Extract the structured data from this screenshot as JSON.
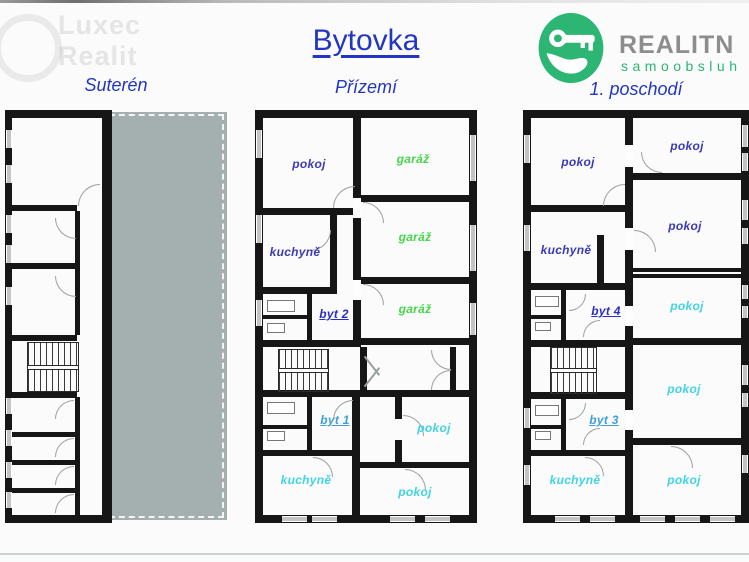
{
  "page": {
    "background": "#fbfbfb",
    "top_strip_color": "#8a8a8a",
    "bottom_strip_color": "#ccd1cf"
  },
  "watermark": {
    "line1": "Luxec",
    "line2": "Realit"
  },
  "header": {
    "title": "Bytovka",
    "title_color": "#2336c2"
  },
  "logo": {
    "brand": "REALITN",
    "subtitle": "samoobsluh",
    "icon": "key-in-hand-icon",
    "green": "#2cb573",
    "brand_gray": "#8d8d8d"
  },
  "colors": {
    "wall": "#161616",
    "terrain_gray": "#a4b0af",
    "label_navy": "#3b3bb8",
    "label_cyan": "#41d4e2",
    "label_green": "#47d44b",
    "label_blue": "#2b2fbe",
    "label_teal": "#3f9fd8"
  },
  "plans": {
    "suteren": {
      "title": "Suterén"
    },
    "prizemi": {
      "title": "Přízemí",
      "rooms": [
        {
          "label": "pokoj",
          "color": "navy"
        },
        {
          "label": "garáž",
          "color": "green"
        },
        {
          "label": "garáž",
          "color": "green"
        },
        {
          "label": "garáž",
          "color": "green"
        },
        {
          "label": "kuchyně",
          "color": "navy"
        },
        {
          "label": "byt 2",
          "color": "blue-underline"
        },
        {
          "label": "byt 1",
          "color": "teal-underline"
        },
        {
          "label": "pokoj",
          "color": "cyan"
        },
        {
          "label": "kuchyně",
          "color": "cyan"
        },
        {
          "label": "pokoj",
          "color": "cyan"
        }
      ]
    },
    "poschodi": {
      "title": "1. poschodí",
      "rooms": [
        {
          "label": "pokoj",
          "color": "navy"
        },
        {
          "label": "pokoj",
          "color": "navy"
        },
        {
          "label": "pokoj",
          "color": "navy"
        },
        {
          "label": "kuchyně",
          "color": "navy"
        },
        {
          "label": "byt 4",
          "color": "blue-underline"
        },
        {
          "label": "pokoj",
          "color": "cyan"
        },
        {
          "label": "byt 3",
          "color": "teal-underline"
        },
        {
          "label": "pokoj",
          "color": "cyan"
        },
        {
          "label": "kuchyně",
          "color": "cyan"
        },
        {
          "label": "pokoj",
          "color": "cyan"
        }
      ]
    }
  }
}
